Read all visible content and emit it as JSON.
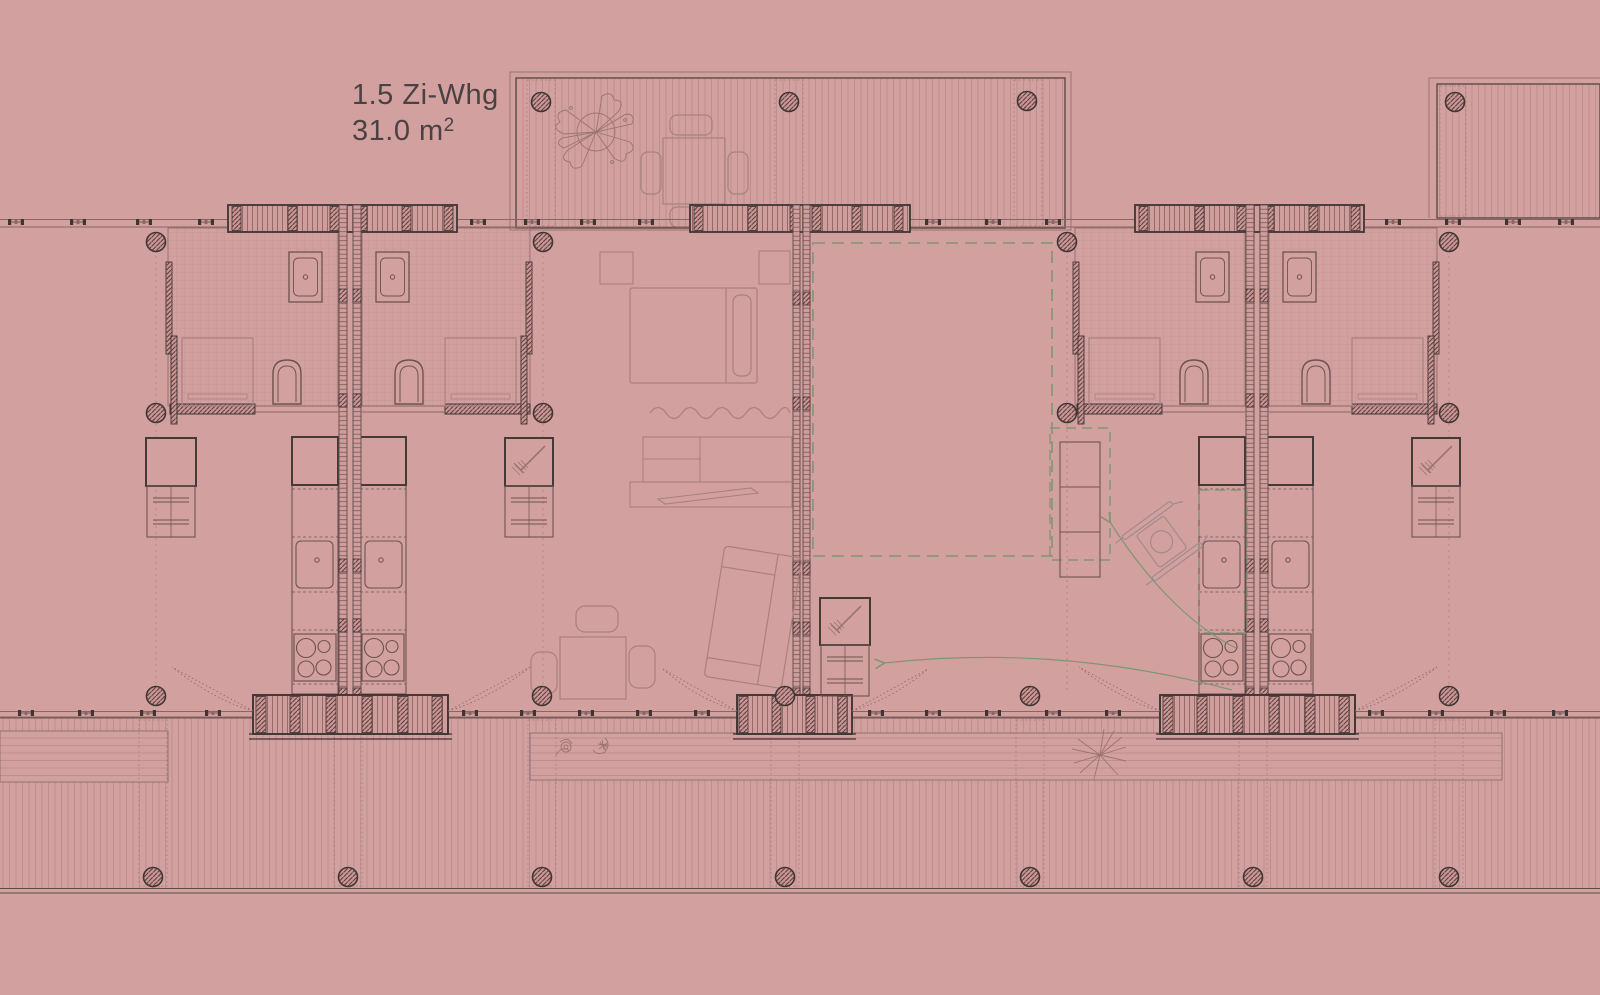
{
  "document": {
    "type": "architectural floor plan",
    "background_color": "#d3a0a0"
  },
  "annotation": {
    "line1": "1.5 Zi-Whg",
    "area": "31.0 m",
    "area_sup": "2"
  },
  "palette": {
    "background": "#d3a0a0",
    "dark_line": "#3f3533",
    "medium_line": "#6d5350",
    "light_line": "#a98080",
    "wall_fill": "#cc9595",
    "accent_green": "#7f9577",
    "text": "#4a4242"
  },
  "plan": {
    "apartment_label": "1.5 Zi-Whg",
    "apartment_area": "31.0 m²",
    "elements": [
      "top terrace deck with plant and dining table",
      "upper right deck",
      "bottom deck with planter band and stair ramp",
      "left apartment service core: two bathrooms, two kitchenettes, wardrobe and broom closet",
      "middle apartment: bed, rug, sideboard with tv, sofa, dining table, utility closet",
      "right apartment service core with accessibility annotations",
      "wheelchair symbol",
      "dashed optional room outline",
      "structural column grid"
    ]
  }
}
